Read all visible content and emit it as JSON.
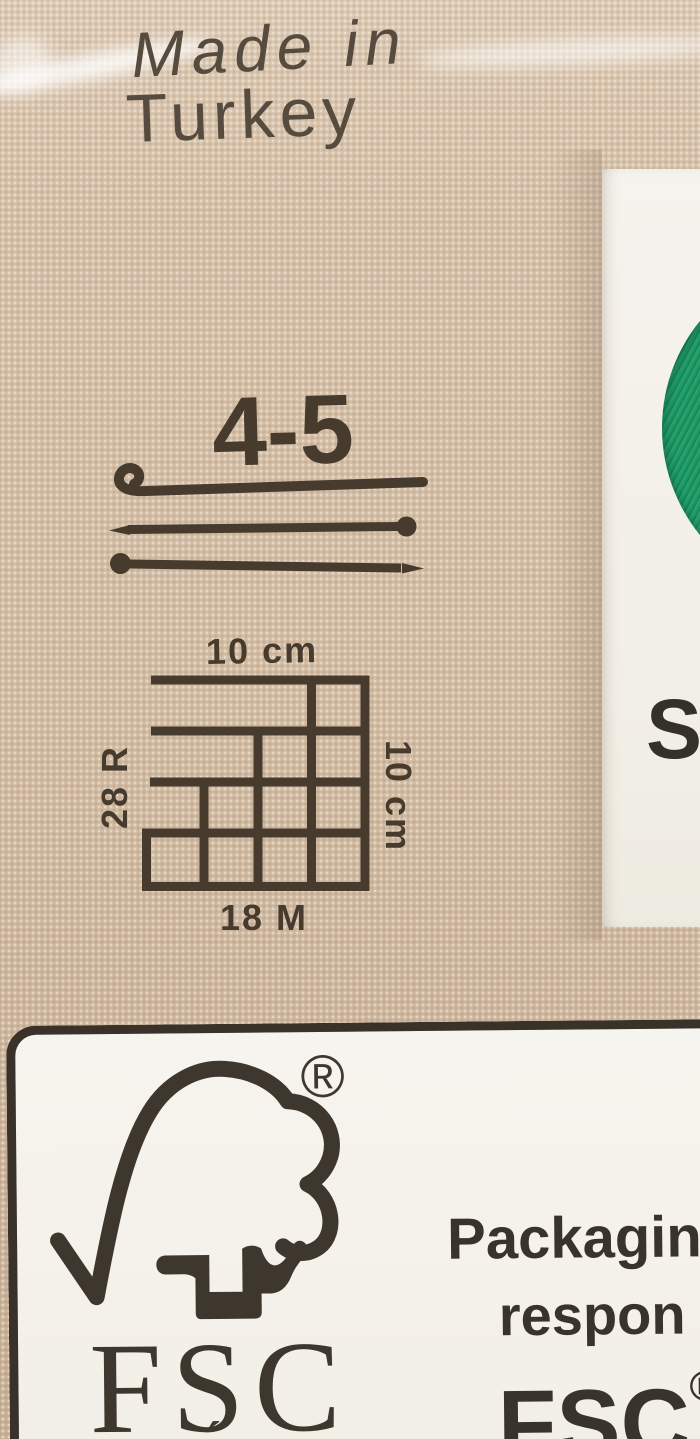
{
  "photo": {
    "origin": {
      "line1": "Made in",
      "line2": "Turkey"
    },
    "tools": {
      "size_range": "4-5"
    },
    "gauge": {
      "width_label": "10 cm",
      "height_label": "10 cm",
      "rows_label": "28 R",
      "stitches_label": "18 M"
    },
    "side_card": {
      "visible_letter": "S"
    },
    "fsc_panel": {
      "logo_acronym": "FSC",
      "registered_mark": "®",
      "subtext_fragment": "´",
      "note_line1": "Packaging",
      "note_line2": "respon",
      "note_line3": "FSC",
      "note_line3_sup": "®"
    },
    "colors": {
      "kraft_tan": "#d2bca4",
      "ink_dark": "#473b2e",
      "card_white": "#f4f2ec",
      "yarn_green": "#1d9c66",
      "panel_border": "#39322b"
    }
  }
}
